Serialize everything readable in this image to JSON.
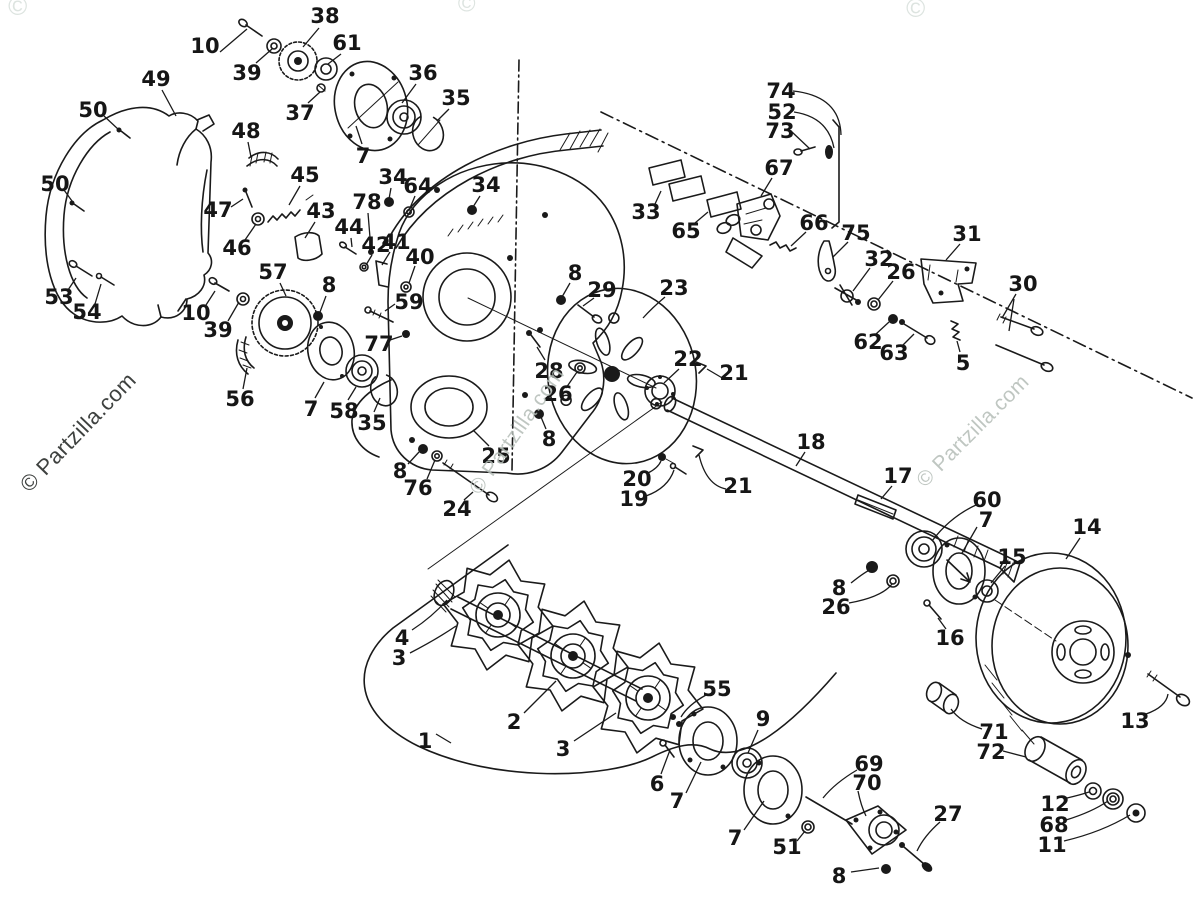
{
  "page": {
    "background": "#ffffff",
    "ink_color": "#1a1a1a",
    "description": "Exploded parts diagram: snowmobile chaincase, drive shaft and track sprockets"
  },
  "watermarks": [
    {
      "name": "watermark-bottom-left",
      "text": "© Partzilla.com",
      "x": 78,
      "y": 432,
      "rotate": -46,
      "size": 22,
      "color": "#2e312f",
      "opacity": 0.92
    },
    {
      "name": "watermark-center",
      "text": "© Partzilla.com",
      "x": 517,
      "y": 431,
      "rotate": -55,
      "size": 21,
      "color": "#b4bdb7",
      "opacity": 0.85
    },
    {
      "name": "watermark-right",
      "text": "© Partzilla.com",
      "x": 973,
      "y": 431,
      "rotate": -45,
      "size": 21,
      "color": "#b4bdb7",
      "opacity": 0.85
    },
    {
      "name": "watermark-top-circle-1",
      "text": "©",
      "x": 18,
      "y": 6,
      "rotate": 0,
      "size": 26,
      "color": "#dde4e0",
      "opacity": 1
    },
    {
      "name": "watermark-top-circle-2",
      "text": "©",
      "x": 467,
      "y": 4,
      "rotate": 0,
      "size": 24,
      "color": "#dde4e0",
      "opacity": 1
    },
    {
      "name": "watermark-top-circle-3",
      "text": "©",
      "x": 916,
      "y": 8,
      "rotate": 0,
      "size": 26,
      "color": "#dde4e0",
      "opacity": 1
    }
  ],
  "diagram": {
    "labels": [
      {
        "t": "10",
        "x": 205,
        "y": 46
      },
      {
        "t": "39",
        "x": 247,
        "y": 73
      },
      {
        "t": "38",
        "x": 325,
        "y": 16
      },
      {
        "t": "61",
        "x": 347,
        "y": 43
      },
      {
        "t": "37",
        "x": 300,
        "y": 113
      },
      {
        "t": "7",
        "x": 363,
        "y": 156
      },
      {
        "t": "36",
        "x": 423,
        "y": 73
      },
      {
        "t": "35",
        "x": 456,
        "y": 98
      },
      {
        "t": "49",
        "x": 156,
        "y": 79
      },
      {
        "t": "50",
        "x": 93,
        "y": 110
      },
      {
        "t": "48",
        "x": 246,
        "y": 131
      },
      {
        "t": "50",
        "x": 55,
        "y": 184
      },
      {
        "t": "45",
        "x": 305,
        "y": 175
      },
      {
        "t": "47",
        "x": 218,
        "y": 210
      },
      {
        "t": "46",
        "x": 237,
        "y": 248
      },
      {
        "t": "43",
        "x": 321,
        "y": 211
      },
      {
        "t": "44",
        "x": 349,
        "y": 227
      },
      {
        "t": "42",
        "x": 376,
        "y": 245
      },
      {
        "t": "41",
        "x": 396,
        "y": 242
      },
      {
        "t": "78",
        "x": 367,
        "y": 202
      },
      {
        "t": "34",
        "x": 393,
        "y": 177
      },
      {
        "t": "64",
        "x": 418,
        "y": 186
      },
      {
        "t": "40",
        "x": 420,
        "y": 257
      },
      {
        "t": "34",
        "x": 486,
        "y": 185
      },
      {
        "t": "8",
        "x": 575,
        "y": 273
      },
      {
        "t": "29",
        "x": 602,
        "y": 290
      },
      {
        "t": "23",
        "x": 674,
        "y": 288
      },
      {
        "t": "53",
        "x": 59,
        "y": 297
      },
      {
        "t": "54",
        "x": 87,
        "y": 312
      },
      {
        "t": "10",
        "x": 196,
        "y": 313
      },
      {
        "t": "39",
        "x": 218,
        "y": 330
      },
      {
        "t": "57",
        "x": 273,
        "y": 272
      },
      {
        "t": "8",
        "x": 329,
        "y": 285
      },
      {
        "t": "56",
        "x": 240,
        "y": 399
      },
      {
        "t": "7",
        "x": 311,
        "y": 409
      },
      {
        "t": "58",
        "x": 344,
        "y": 411
      },
      {
        "t": "35",
        "x": 372,
        "y": 423
      },
      {
        "t": "59",
        "x": 409,
        "y": 302
      },
      {
        "t": "77",
        "x": 379,
        "y": 344
      },
      {
        "t": "25",
        "x": 496,
        "y": 456
      },
      {
        "t": "8",
        "x": 400,
        "y": 471
      },
      {
        "t": "76",
        "x": 418,
        "y": 488
      },
      {
        "t": "24",
        "x": 457,
        "y": 509
      },
      {
        "t": "28",
        "x": 549,
        "y": 371
      },
      {
        "t": "26",
        "x": 558,
        "y": 394
      },
      {
        "t": "8",
        "x": 549,
        "y": 439
      },
      {
        "t": "22",
        "x": 688,
        "y": 359
      },
      {
        "t": "21",
        "x": 734,
        "y": 373
      },
      {
        "t": "20",
        "x": 637,
        "y": 479
      },
      {
        "t": "19",
        "x": 634,
        "y": 499
      },
      {
        "t": "21",
        "x": 738,
        "y": 486
      },
      {
        "t": "18",
        "x": 811,
        "y": 442
      },
      {
        "t": "17",
        "x": 898,
        "y": 476
      },
      {
        "t": "33",
        "x": 646,
        "y": 212
      },
      {
        "t": "65",
        "x": 686,
        "y": 231
      },
      {
        "t": "67",
        "x": 779,
        "y": 168
      },
      {
        "t": "74",
        "x": 781,
        "y": 91
      },
      {
        "t": "52",
        "x": 782,
        "y": 112
      },
      {
        "t": "73",
        "x": 780,
        "y": 131
      },
      {
        "t": "66",
        "x": 814,
        "y": 223
      },
      {
        "t": "75",
        "x": 856,
        "y": 233
      },
      {
        "t": "32",
        "x": 879,
        "y": 259
      },
      {
        "t": "26",
        "x": 901,
        "y": 272
      },
      {
        "t": "62",
        "x": 868,
        "y": 342
      },
      {
        "t": "63",
        "x": 894,
        "y": 353
      },
      {
        "t": "31",
        "x": 967,
        "y": 234
      },
      {
        "t": "30",
        "x": 1023,
        "y": 284
      },
      {
        "t": "5",
        "x": 963,
        "y": 363
      },
      {
        "t": "60",
        "x": 987,
        "y": 500
      },
      {
        "t": "7",
        "x": 986,
        "y": 520
      },
      {
        "t": "15",
        "x": 1012,
        "y": 557
      },
      {
        "t": "14",
        "x": 1087,
        "y": 527
      },
      {
        "t": "8",
        "x": 839,
        "y": 588
      },
      {
        "t": "26",
        "x": 836,
        "y": 607
      },
      {
        "t": "16",
        "x": 950,
        "y": 638
      },
      {
        "t": "13",
        "x": 1135,
        "y": 721
      },
      {
        "t": "71",
        "x": 994,
        "y": 732
      },
      {
        "t": "72",
        "x": 991,
        "y": 752
      },
      {
        "t": "12",
        "x": 1055,
        "y": 804
      },
      {
        "t": "68",
        "x": 1054,
        "y": 825
      },
      {
        "t": "11",
        "x": 1052,
        "y": 845
      },
      {
        "t": "4",
        "x": 402,
        "y": 638
      },
      {
        "t": "3",
        "x": 399,
        "y": 658
      },
      {
        "t": "2",
        "x": 514,
        "y": 722
      },
      {
        "t": "3",
        "x": 563,
        "y": 749
      },
      {
        "t": "1",
        "x": 425,
        "y": 741
      },
      {
        "t": "55",
        "x": 717,
        "y": 689
      },
      {
        "t": "6",
        "x": 657,
        "y": 784
      },
      {
        "t": "7",
        "x": 677,
        "y": 801
      },
      {
        "t": "9",
        "x": 763,
        "y": 719
      },
      {
        "t": "7",
        "x": 735,
        "y": 838
      },
      {
        "t": "51",
        "x": 787,
        "y": 847
      },
      {
        "t": "69",
        "x": 869,
        "y": 764
      },
      {
        "t": "70",
        "x": 867,
        "y": 783
      },
      {
        "t": "8",
        "x": 839,
        "y": 876
      },
      {
        "t": "27",
        "x": 948,
        "y": 814
      }
    ],
    "leaders": [
      "M220,52 L247,29",
      "M256,63 L272,49",
      "M319,28 L303,47",
      "M341,54 L328,64",
      "M308,103 L320,92",
      "M362,144 L356,126",
      "M416,84 L402,103",
      "M449,109 L437,121",
      "M162,90 L176,116",
      "M104,116 L119,130",
      "M248,142 L251,157",
      "M64,190 L72,201",
      "M300,186 L289,205",
      "M231,207 L243,199",
      "M245,240 L256,224",
      "M315,222 L305,238",
      "M351,238 L352,247",
      "M372,255 L366,265",
      "M390,252 L382,265",
      "M368,213 L371,250",
      "M391,188 L389,199",
      "M415,196 L410,208",
      "M415,266 L409,283",
      "M480,196 L473,207",
      "M570,283 L562,297",
      "M594,298 L583,306",
      "M665,297 Q652,308 643,318",
      "M68,290 L76,278",
      "M95,304 L101,284",
      "M206,305 L215,291",
      "M228,321 L239,302",
      "M280,283 L286,296",
      "M326,296 L320,312",
      "M243,389 L247,368",
      "M315,398 L324,382",
      "M348,400 L356,387",
      "M374,412 L380,398",
      "M395,304 L385,311",
      "M390,340 L402,336",
      "M489,446 L473,430",
      "M408,464 L419,452",
      "M427,479 L435,460",
      "M464,500 L473,492",
      "M545,360 L537,347",
      "M566,388 L577,372",
      "M546,429 L541,417",
      "M679,369 L664,383",
      "M724,379 L707,369",
      "M648,473 Q658,468 661,461",
      "M646,496 Q668,488 674,470",
      "M726,489 Q706,485 699,455",
      "M805,452 L796,466",
      "M892,486 L881,499",
      "M655,204 L661,191",
      "M695,223 L708,212",
      "M772,178 L761,196",
      "M793,91 Q840,96 841,135",
      "M794,112 Q828,117 834,148",
      "M792,132 L810,149",
      "M806,232 L791,246",
      "M848,242 L833,257",
      "M870,268 L853,291",
      "M893,281 L878,300",
      "M876,334 L889,322",
      "M902,346 L914,334",
      "M960,244 L946,260",
      "M1016,294 L1002,318",
      "M1014,299 L1009,331",
      "M960,352 L957,341",
      "M976,505 Q950,517 932,541",
      "M977,527 L962,553",
      "M1005,566 L991,583",
      "M1080,538 L1066,559",
      "M851,583 Q866,571 872,569",
      "M849,603 Q882,597 892,584",
      "M946,629 L938,618",
      "M1146,714 Q1166,707 1168,694",
      "M982,729 Q960,722 951,709",
      "M1003,751 L1026,757",
      "M1067,798 Q1080,795 1089,792",
      "M1066,820 Q1092,812 1108,801",
      "M1064,841 Q1102,832 1130,815",
      "M412,630 Q432,617 447,600",
      "M410,653 Q437,639 456,626",
      "M524,713 L556,681",
      "M574,741 L616,713",
      "M436,734 L451,743",
      "M706,695 Q688,705 681,717",
      "M661,774 L670,750",
      "M686,793 L701,762",
      "M758,730 L748,753",
      "M744,830 L764,801",
      "M797,841 L805,831",
      "M857,770 Q835,783 823,798",
      "M858,791 Q861,806 866,816",
      "M851,872 L879,868",
      "M940,822 Q924,836 917,851"
    ]
  }
}
